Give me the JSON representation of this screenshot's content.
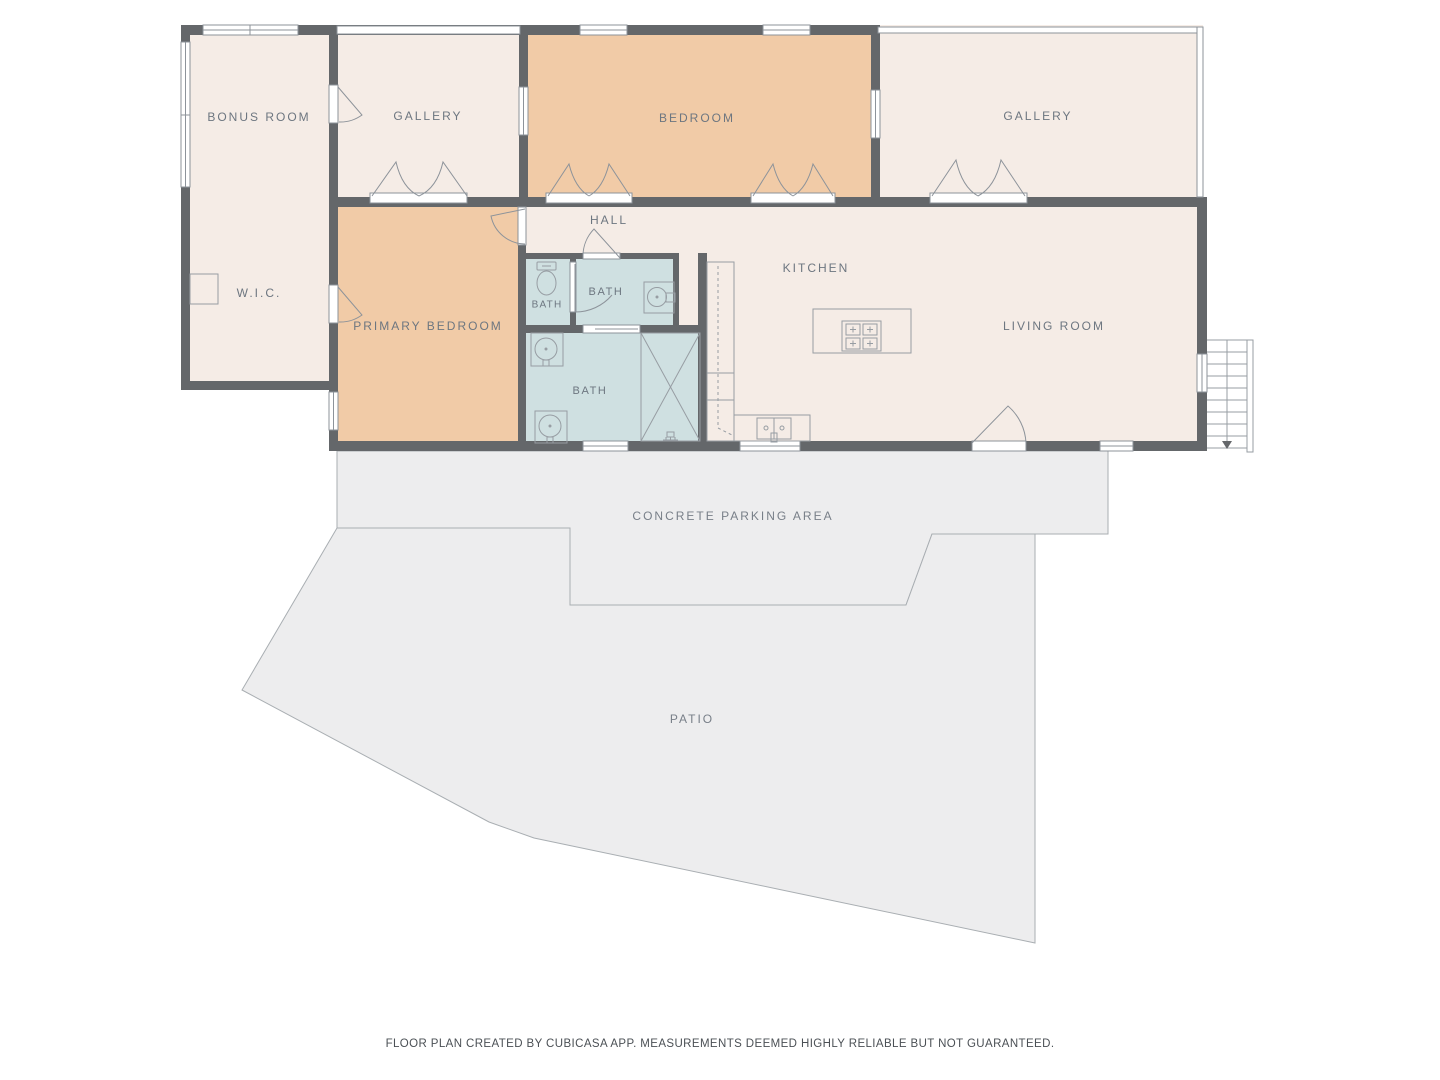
{
  "palette": {
    "wall": "#64676a",
    "room_fill": "#f5ece6",
    "bedroom_fill": "#f1cba7",
    "bath_fill": "#cfe0e1",
    "outdoor_fill": "#ededee",
    "fixture_line": "#979da3",
    "label_text": "#6d7680",
    "footer_text": "#4b5055"
  },
  "labels": {
    "bonus_room": "BONUS ROOM",
    "gallery_left": "GALLERY",
    "bedroom": "BEDROOM",
    "gallery_right": "GALLERY",
    "wic": "W.I.C.",
    "primary_bedroom": "PRIMARY BEDROOM",
    "hall": "HALL",
    "bath_small": "BATH",
    "bath_middle": "BATH",
    "bath_large": "BATH",
    "kitchen": "KITCHEN",
    "living_room": "LIVING ROOM",
    "parking": "CONCRETE PARKING AREA",
    "patio": "PATIO"
  },
  "footer": {
    "note": "FLOOR PLAN CREATED BY CUBICASA APP. MEASUREMENTS DEEMED HIGHLY RELIABLE BUT NOT GUARANTEED."
  }
}
